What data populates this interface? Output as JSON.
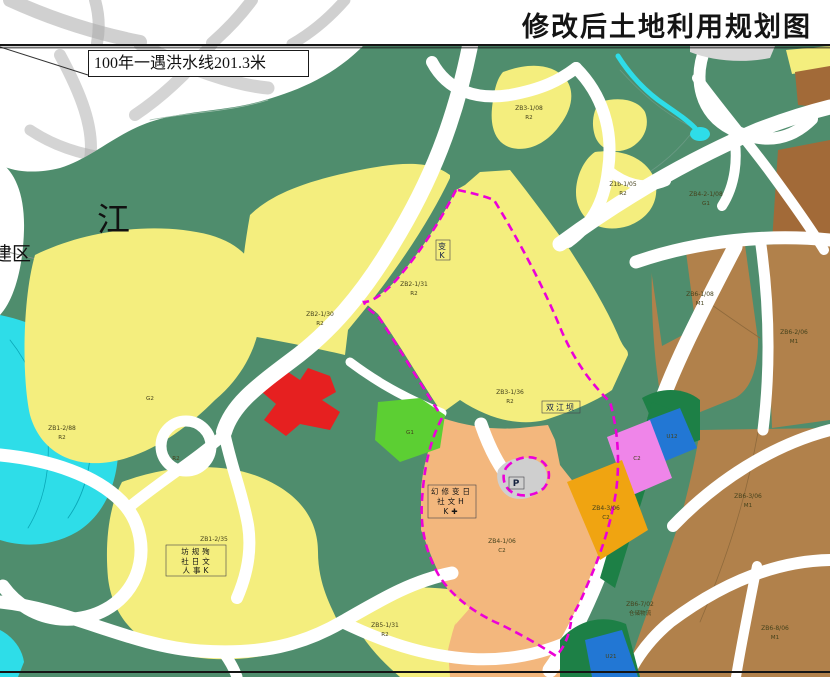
{
  "header": {
    "title": "修改后土地利用规划图"
  },
  "map_labels": {
    "flood_line": "100年一遇洪水线201.3米",
    "river": "江",
    "district": "建区",
    "parking": "P",
    "boxed_zone": "双江坝",
    "box_small_top": "变",
    "box_small_bottom": "K"
  },
  "clusters": {
    "c1_row1": "坊规殉",
    "c1_row2": "社日文",
    "c1_row3": "人事K",
    "c2_row1": "幻修变日",
    "c2_row2": "社文H",
    "c2_row3": "K✚"
  },
  "parcels": {
    "p1_code": "ZB2-1/30",
    "p1_type": "R2",
    "p2_code": "ZB2-1/31",
    "p2_type": "R2",
    "p3_code": "ZB3-1/36",
    "p3_type": "R2",
    "p4_code": "ZB1-2/88",
    "p4_type": "R2",
    "p5_type": "R2",
    "p6_code": "ZB1-2/35",
    "p7_code": "ZB5-1/31",
    "p7_type": "R2",
    "p8_code": "ZB3-1/08",
    "p8_type": "R2",
    "p9_code": "Z1b-1/05",
    "p9_type": "R2",
    "p10_code": "ZB4-2-1/08",
    "p10_type": "G1",
    "p11_type": "G2",
    "p12_type": "G1",
    "p13_code": "ZB4-1/06",
    "p13_type": "C2",
    "p14_code": "ZB4-3/06",
    "p14_type": "C2",
    "p15_type": "C2",
    "p16_type": "U12",
    "p17_type": "U21",
    "p18_code": "ZB6-1/08",
    "p18_type": "M1",
    "p19_code": "ZB6-2/06",
    "p19_type": "M1",
    "p20_code": "ZB6-3/06",
    "p20_type": "M1",
    "p21_code": "ZB6-7/02",
    "p21_type": "仓储物流",
    "p22_code": "ZB6-8/06",
    "p22_type": "M1"
  },
  "palette": {
    "green_base": "#4f8d6d",
    "deep_green": "#1d8046",
    "road_white": "#ffffff",
    "residential_yellow": "#f4ee7e",
    "peach": "#f3b77d",
    "gold": "#f0a411",
    "red": "#e62020",
    "bright_green": "#5ccf33",
    "cyan": "#2edde8",
    "pink": "#ef85e9",
    "blue": "#2277d4",
    "brown": "#b1814b",
    "brown_dark": "#a26a38",
    "gray_parcel": "#cfcfcf",
    "gray_patch": "#d8d8d8",
    "white_land": "#ffffff",
    "boundary_magenta": "#ec00d8",
    "watermark_gray": "#a9a9a9",
    "frame": "#151515"
  }
}
